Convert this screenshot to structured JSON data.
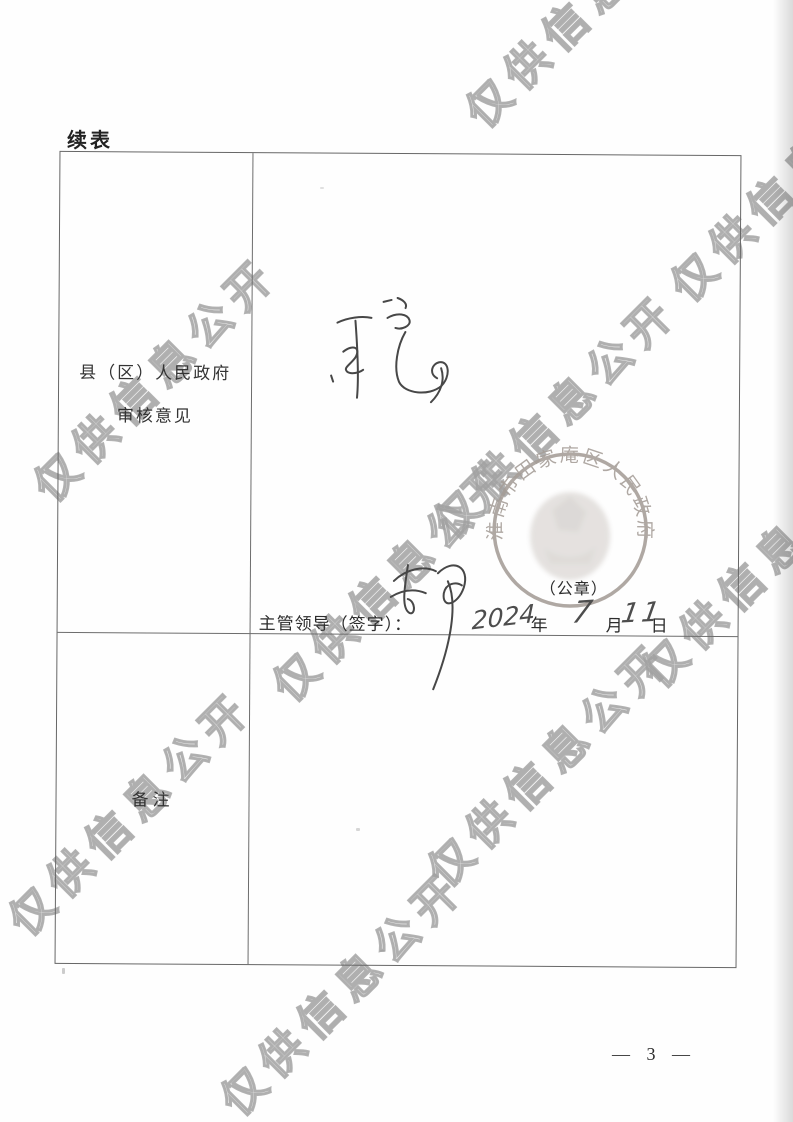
{
  "page": {
    "continued_label": "续表",
    "page_number": "— 3 —"
  },
  "watermark": {
    "text": "仅供信息公开",
    "color": "#a0a0a0",
    "positions": [
      {
        "x": 492,
        "y": 138
      },
      {
        "x": 697,
        "y": 312
      },
      {
        "x": 60,
        "y": 512
      },
      {
        "x": 460,
        "y": 549
      },
      {
        "x": 299,
        "y": 712
      },
      {
        "x": 668,
        "y": 698
      },
      {
        "x": 454,
        "y": 897
      },
      {
        "x": 35,
        "y": 946
      },
      {
        "x": 247,
        "y": 1126
      }
    ]
  },
  "table": {
    "review_row": {
      "label_line1": "县（区）人民政府",
      "label_line2": "审核意见",
      "handwritten_comment": "同意",
      "seal": {
        "ring_text": "淮南市田家庵区人民政府",
        "caption": "（公章）",
        "color": "#a59d97"
      },
      "sign_line": {
        "label": "主管领导（签字）：",
        "year_value": "2024",
        "year_unit": "年",
        "month_value": "7",
        "month_unit": "月",
        "day_value": "11",
        "day_unit": "日"
      }
    },
    "remarks_row": {
      "label": "备注",
      "content": ""
    }
  }
}
